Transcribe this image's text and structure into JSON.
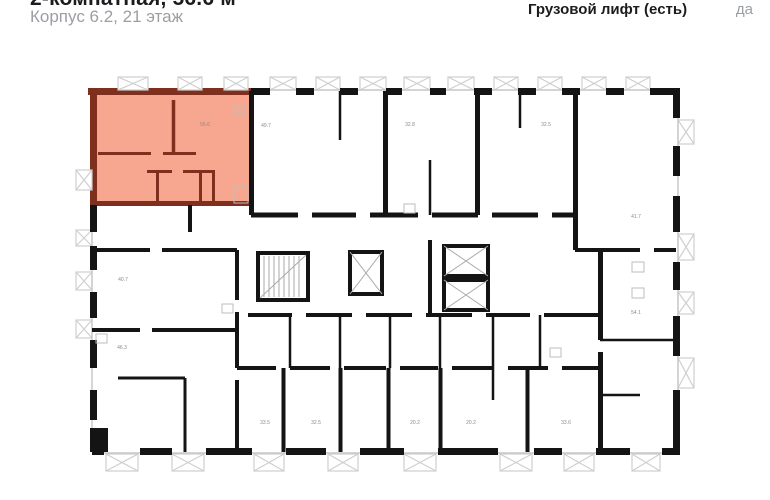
{
  "header": {
    "title": "2-комнатная, 56.6 м²",
    "subtitle": "Корпус 6.2, 21 этаж",
    "spec": {
      "label": "Грузовой лифт (есть)",
      "value": "да"
    }
  },
  "floorplan": {
    "colors": {
      "highlight_fill": "#F7A78F",
      "highlight_wall": "#7E2F1E",
      "wall": "#141414",
      "window": "#c9c9c9",
      "balcony": "#cfcfcf",
      "label": "#8a8a8a"
    },
    "highlighted_unit": {
      "type": "2-комнатная",
      "area": "56.6"
    },
    "unit_labels": [
      {
        "text": "56.6",
        "x": 205,
        "y": 126,
        "highlighted": true
      },
      {
        "text": "49.7",
        "x": 266,
        "y": 127
      },
      {
        "text": "32.8",
        "x": 410,
        "y": 126
      },
      {
        "text": "32.5",
        "x": 546,
        "y": 126
      },
      {
        "text": "41.7",
        "x": 636,
        "y": 218
      },
      {
        "text": "40.7",
        "x": 123,
        "y": 281
      },
      {
        "text": "54.1",
        "x": 636,
        "y": 314
      },
      {
        "text": "46.3",
        "x": 122,
        "y": 349
      },
      {
        "text": "33.5",
        "x": 265,
        "y": 424
      },
      {
        "text": "32.5",
        "x": 316,
        "y": 424
      },
      {
        "text": "20.2",
        "x": 415,
        "y": 424
      },
      {
        "text": "20.2",
        "x": 471,
        "y": 424
      },
      {
        "text": "33.6",
        "x": 566,
        "y": 424
      }
    ]
  }
}
